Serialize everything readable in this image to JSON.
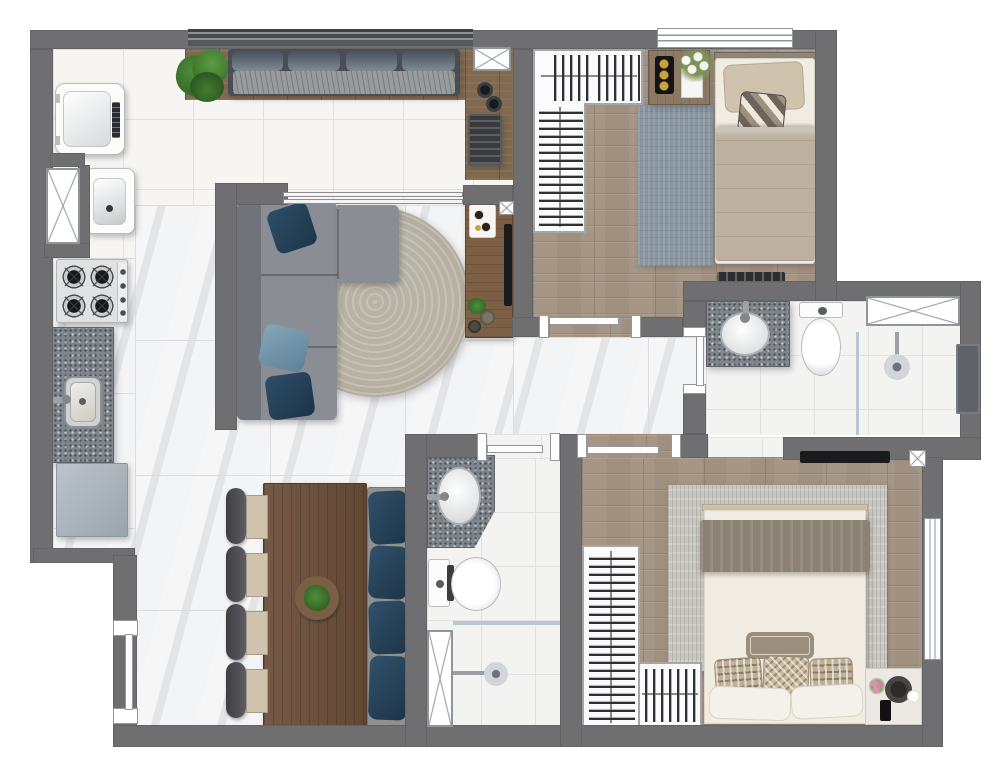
{
  "canvas": {
    "width": 1000,
    "height": 777,
    "background": "#ffffff"
  },
  "palette": {
    "wall": "#6f6f72",
    "floor_tile": "#f6f5f2",
    "tile_grout": "#e3e1dc",
    "marble": "#ebecee",
    "marble_grout": "#dcdde0",
    "bath_tile": "#f3f3f1",
    "bath_grout": "#e1e1df",
    "wood_floor": "#a09080",
    "deck_wood": "#80694f",
    "table_wood": "#6a4e38",
    "console_wood": "#7d5f45",
    "nightstand_wood": "#8d7a65",
    "sofa": "#8a8e94",
    "sofa_back": "#70747a",
    "cushion_back": "#5a6067",
    "pillow_navy": "#28455c",
    "pillow_blue": "#7292a6",
    "rug_round": "#b4afa1",
    "rug_bedroom1": "#8894a0",
    "rug_bedroom2": "#c9c7c1",
    "bed_white": "#f1ece2",
    "blanket_beige": "#bcb0a0",
    "blanket_taupe": "#8b8174",
    "pillow_beige": "#cfc3ad",
    "granite": "#7f868b",
    "cabinet": "#aeb7bd",
    "fixture": "#fcfcfb",
    "fixture_edge": "#b9bcbf",
    "glass": "#b9c8ce",
    "tv": "#1b1b1e",
    "grill": "#3a3b3f",
    "plant_dark": "#2c5a22",
    "plant_light": "#4f8f3a",
    "gold": "#c9a23c",
    "window_line": "#8f9598"
  },
  "icons": {
    "window-x-icon": "white box with diagonal cross",
    "shaft-icon": "small white box with diagonal cross",
    "shower-head-icon": "chrome disc with supply arm",
    "burner-icon": "black ring with cross grate",
    "door-icon": "white jambs with open leaf bar",
    "hanger-rail-icon": "rail with clothes strokes"
  },
  "rooms": [
    {
      "id": "balcony-terrace",
      "floor": "white-tile",
      "items": [
        "deck-band",
        "bench-sofa",
        "plant",
        "grill-counter",
        "window"
      ]
    },
    {
      "id": "laundry",
      "floor": "white-tile",
      "items": [
        "washing-machine",
        "laundry-sink",
        "window"
      ]
    },
    {
      "id": "kitchen",
      "floor": "marble",
      "items": [
        "cooktop",
        "granite-counter-sink",
        "lower-cabinet"
      ]
    },
    {
      "id": "living-dining",
      "floor": "marble",
      "items": [
        "l-sofa",
        "round-rug",
        "tv-console",
        "dining-table",
        "four-chairs",
        "bench-with-pillows"
      ]
    },
    {
      "id": "hall",
      "floor": "marble",
      "items": []
    },
    {
      "id": "bedroom-1",
      "floor": "wood",
      "items": [
        "l-closet",
        "single-bed",
        "nightstand",
        "rug",
        "window"
      ]
    },
    {
      "id": "suite-bathroom",
      "floor": "white-tile",
      "items": [
        "granite-vanity",
        "toilet",
        "shower",
        "window",
        "towel-bar"
      ]
    },
    {
      "id": "social-bathroom",
      "floor": "white-tile",
      "items": [
        "granite-vanity",
        "toilet",
        "shower",
        "window"
      ]
    },
    {
      "id": "bedroom-2",
      "floor": "wood",
      "items": [
        "l-closet",
        "double-bed",
        "nightstand",
        "rug",
        "tv",
        "window"
      ]
    }
  ]
}
